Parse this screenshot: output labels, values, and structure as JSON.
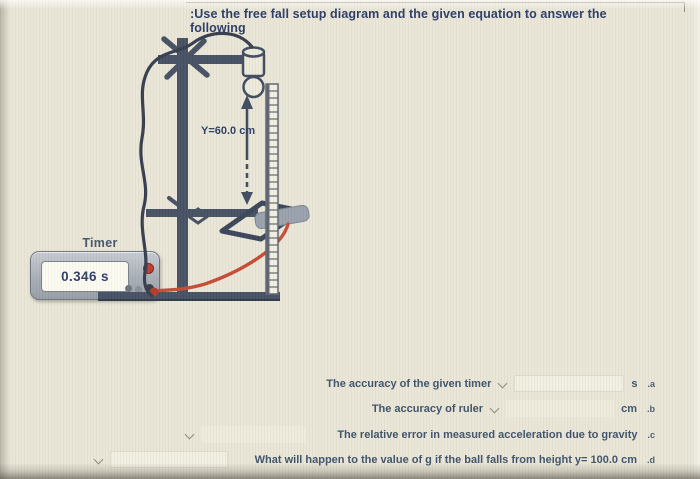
{
  "page": {
    "title": ":Use the free fall setup diagram and the given equation to answer the following"
  },
  "diagram": {
    "height_label": "Y=60.0 cm",
    "timer_label": "Timer",
    "timer_reading": "0.346 s"
  },
  "questions": [
    {
      "label": "The accuracy of the given timer",
      "unit": "s",
      "letter": ".a"
    },
    {
      "label": "The accuracy of ruler",
      "unit": "cm",
      "letter": ".b"
    },
    {
      "label": "The relative error in measured acceleration due to gravity",
      "unit": "",
      "letter": ".c"
    },
    {
      "label": "What will happen to the value of g if the ball falls from height y= 100.0 cm",
      "unit": "",
      "letter": ".d"
    }
  ],
  "icons": {
    "dropdown": "chevron-down"
  },
  "colors": {
    "background": "#e9e6d7",
    "title_text": "#2b3a64",
    "question_text": "#3d5169",
    "apparatus": "#454f63",
    "wire_red": "#c64a33",
    "timer_body": "#aab0b8",
    "pad_gray": "#98a0ac"
  }
}
